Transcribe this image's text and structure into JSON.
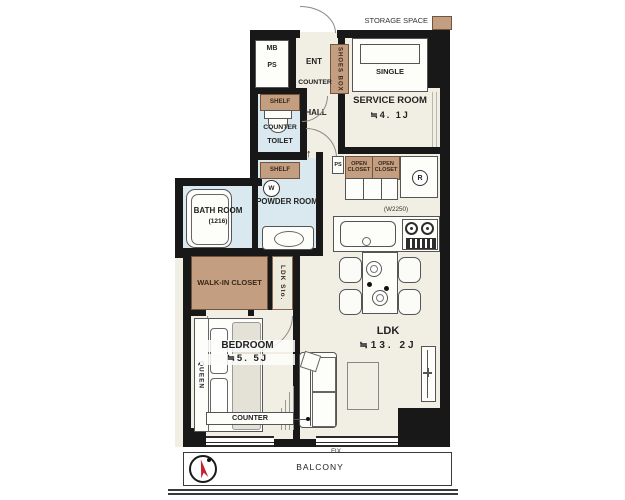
{
  "legend": {
    "storage_space": "STORAGE SPACE"
  },
  "entry": {
    "ent": "ENT",
    "hall": "HALL",
    "counter": "COUNTER",
    "shoes_box": "SHOES BOX",
    "mb": "MB",
    "ps": "PS"
  },
  "service_room": {
    "name": "SERVICE ROOM",
    "size": "≒4. 1J",
    "bed": "SINGLE"
  },
  "toilet": {
    "shelf": "SHELF",
    "counter": "COUNTER",
    "name": "TOILET"
  },
  "powder_room": {
    "shelf": "SHELF",
    "washer": "W",
    "name": "POWDER ROOM"
  },
  "bath_room": {
    "name": "BATH ROOM",
    "size": "(1216)"
  },
  "storage": {
    "open_closet_1": "OPEN CLOSET",
    "open_closet_2": "OPEN CLOSET",
    "ps_small": "PS",
    "fridge": "R",
    "walk_in_closet": "WALK-IN CLOSET",
    "ldk_sto": "LDK Sto."
  },
  "kitchen": {
    "width_label": "(W2250)"
  },
  "ldk": {
    "name": "LDK",
    "size": "≒13. 2J"
  },
  "bedroom": {
    "name": "BEDROOM",
    "size": "≒5. 5J",
    "bed": "QUEEN",
    "counter": "COUNTER"
  },
  "balcony": {
    "name": "BALCONY",
    "fix": "FIX"
  },
  "symbols": {
    "up_arrow": "↑"
  },
  "colors": {
    "wall": "#181818",
    "floor": "#f1efe4",
    "wet_floor": "#d9e9ef",
    "storage_tan": "#c49e80",
    "compass_red": "#c42430"
  }
}
